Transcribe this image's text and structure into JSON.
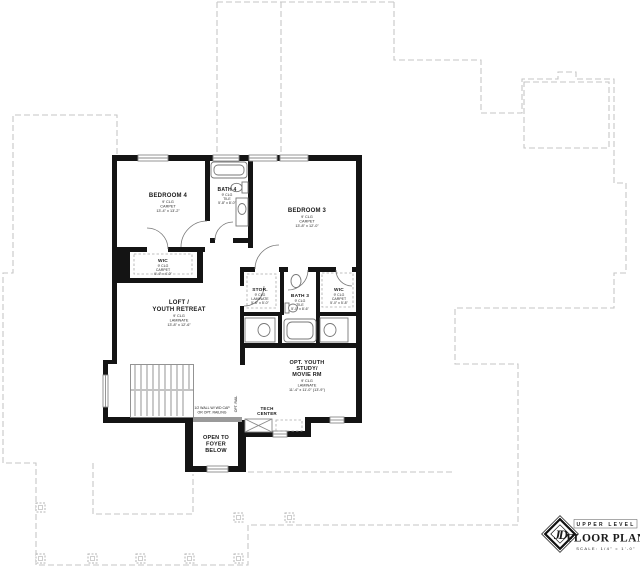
{
  "colors": {
    "wall": "#141414",
    "lower_level_outline": "#c6c6c6",
    "fixture_line": "#777777",
    "text": "#1a1a1a"
  },
  "rooms": {
    "bedroom4": {
      "name": "BEDROOM 4",
      "clg": "9' CLG",
      "floor": "CARPET",
      "dims": "13'-4\" x 13'-2\""
    },
    "bath4": {
      "name": "BATH 4",
      "clg": "9' CLG",
      "floor": "TILE",
      "dims": "5'-8\" x 8'-0\""
    },
    "bedroom3": {
      "name": "BEDROOM 3",
      "clg": "9' CLG",
      "floor": "CARPET",
      "dims": "13'-8\" x 12'-0\""
    },
    "wic_left": {
      "name": "WIC",
      "clg": "9' CLG",
      "floor": "CARPET",
      "dims": "6'-4\" x 4'-0\""
    },
    "loft": {
      "name_line1": "LOFT /",
      "name_line2": "YOUTH RETREAT",
      "clg": "9' CLG",
      "floor": "LAMINATE",
      "dims": "13'-8\" x 12'-6\""
    },
    "stor": {
      "name": "STOR.",
      "clg": "9' CLG",
      "floor": "LAMINATE",
      "dims": "5'-8\" x 5'-0\""
    },
    "bath3": {
      "name": "BATH 3",
      "clg": "9' CLG",
      "floor": "TILE",
      "dims": "5'-0\" x 8'-6\""
    },
    "wic_right": {
      "name": "WIC",
      "clg": "9' CLG",
      "floor": "CARPET",
      "dims": "5'-0\" x 5'-8\""
    },
    "study": {
      "name_line1": "OPT. YOUTH",
      "name_line2": "STUDY/",
      "name_line3": "MOVIE RM",
      "clg": "9' CLG",
      "floor": "LAMINATE",
      "dims": "11'-4\" x 11'-0\" (13'-9\")"
    },
    "tech": {
      "name_line1": "TECH",
      "name_line2": "CENTER"
    },
    "foyer": {
      "line1": "OPEN TO",
      "line2": "FOYER",
      "line3": "BELOW"
    }
  },
  "annotations": {
    "half_wall_line1": "1/2 WALL W/ WD CAP",
    "half_wall_line2": "OR OPT. RAILING",
    "opt_rail": "OPT. RAIL"
  },
  "title_block": {
    "monogram": "JD",
    "level": "UPPER LEVEL",
    "plan": "FLOOR PLAN",
    "scale": "SCALE: 1/4\" = 1'-0\""
  }
}
